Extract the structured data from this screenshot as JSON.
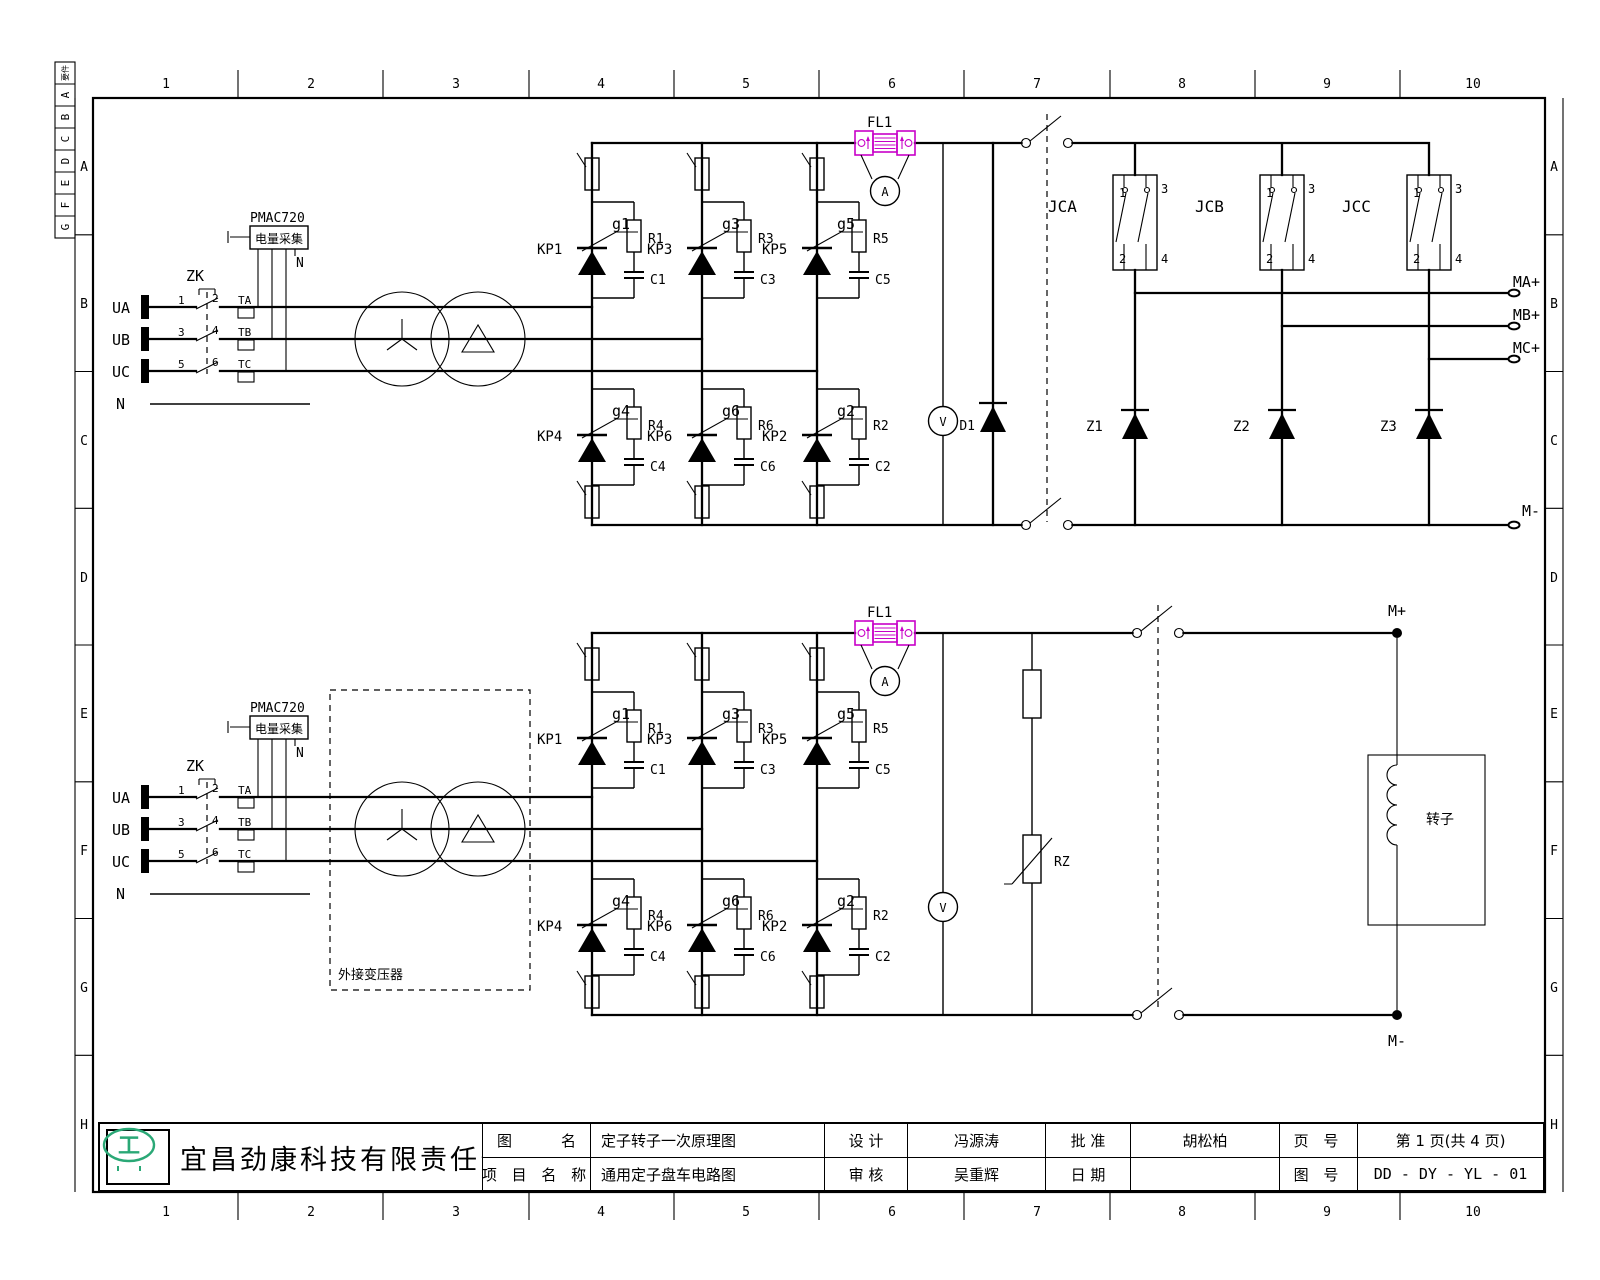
{
  "sheet": {
    "cols": [
      "1",
      "2",
      "3",
      "4",
      "5",
      "6",
      "7",
      "8",
      "9",
      "10"
    ],
    "rows": [
      "A",
      "B",
      "C",
      "D",
      "E",
      "F",
      "G",
      "H"
    ],
    "legend": [
      "要件",
      "A",
      "B",
      "C",
      "D",
      "E",
      "F",
      "G"
    ]
  },
  "stator": {
    "breaker": "ZK",
    "neutral": "N",
    "phases": [
      {
        "label": "UA",
        "nl": "1",
        "nr": "2",
        "ct": "TA"
      },
      {
        "label": "UB",
        "nl": "3",
        "nr": "4",
        "ct": "TB"
      },
      {
        "label": "UC",
        "nl": "5",
        "nr": "6",
        "ct": "TC"
      }
    ],
    "pmac": {
      "model": "PMAC720",
      "name": "电量采集",
      "n": "N"
    },
    "fuse": "FL1",
    "ammeter": "A",
    "voltmeter": "V",
    "diode": "D1",
    "bridge": {
      "upper": [
        {
          "kp": "KP1",
          "g": "g1",
          "r": "R1",
          "c": "C1"
        },
        {
          "kp": "KP3",
          "g": "g3",
          "r": "R3",
          "c": "C3"
        },
        {
          "kp": "KP5",
          "g": "g5",
          "r": "R5",
          "c": "C5"
        }
      ],
      "lower": [
        {
          "kp": "KP4",
          "g": "g4",
          "r": "R4",
          "c": "C4"
        },
        {
          "kp": "KP6",
          "g": "g6",
          "r": "R6",
          "c": "C6"
        },
        {
          "kp": "KP2",
          "g": "g2",
          "r": "R2",
          "c": "C2"
        }
      ]
    },
    "contactors": [
      {
        "label": "JCA",
        "p1": "1",
        "p2": "2",
        "p3": "3",
        "p4": "4"
      },
      {
        "label": "JCB",
        "p1": "1",
        "p2": "2",
        "p3": "3",
        "p4": "4"
      },
      {
        "label": "JCC",
        "p1": "1",
        "p2": "2",
        "p3": "3",
        "p4": "4"
      }
    ],
    "z": [
      "Z1",
      "Z2",
      "Z3"
    ],
    "outputs": [
      "MA+",
      "MB+",
      "MC+"
    ],
    "minus": "M-"
  },
  "rotor": {
    "breaker": "ZK",
    "neutral": "N",
    "phases": [
      {
        "label": "UA",
        "nl": "1",
        "nr": "2",
        "ct": "TA"
      },
      {
        "label": "UB",
        "nl": "3",
        "nr": "4",
        "ct": "TB"
      },
      {
        "label": "UC",
        "nl": "5",
        "nr": "6",
        "ct": "TC"
      }
    ],
    "pmac": {
      "model": "PMAC720",
      "name": "电量采集",
      "n": "N"
    },
    "ext_box": "外接变压器",
    "fuse": "FL1",
    "ammeter": "A",
    "voltmeter": "V",
    "varistor": "RZ",
    "bridge": {
      "upper": [
        {
          "kp": "KP1",
          "g": "g1",
          "r": "R1",
          "c": "C1"
        },
        {
          "kp": "KP3",
          "g": "g3",
          "r": "R3",
          "c": "C3"
        },
        {
          "kp": "KP5",
          "g": "g5",
          "r": "R5",
          "c": "C5"
        }
      ],
      "lower": [
        {
          "kp": "KP4",
          "g": "g4",
          "r": "R4",
          "c": "C4"
        },
        {
          "kp": "KP6",
          "g": "g6",
          "r": "R6",
          "c": "C6"
        },
        {
          "kp": "KP2",
          "g": "g2",
          "r": "R2",
          "c": "C2"
        }
      ]
    },
    "plus": "M+",
    "minus": "M-",
    "winding": "转子"
  },
  "titleblock": {
    "company": "宜昌劲康科技有限责任公司",
    "logo_glyph": "工",
    "fig_l": "图",
    "fig_r": "名",
    "fig_name": "定子转子一次原理图",
    "project_label": "项 目 名 称",
    "project_name": "通用定子盘车电路图",
    "design_label": "设  计",
    "designer": "冯源涛",
    "check_label": "审  核",
    "checker": "吴重辉",
    "approve_label": "批  准",
    "approver": "胡松柏",
    "date_label": "日  期",
    "date": "",
    "page_label": "页 号",
    "page": "第 1 页(共 4 页)",
    "no_label": "图 号",
    "no": "DD - DY - YL - 01"
  }
}
